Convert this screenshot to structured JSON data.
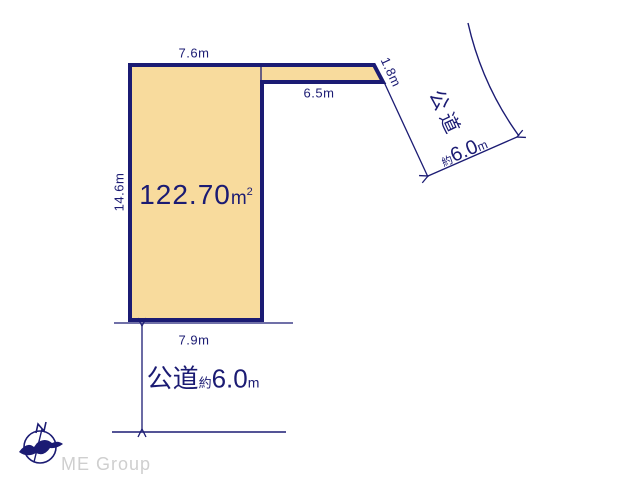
{
  "parcel": {
    "area": {
      "value": "122.70",
      "unit_base": "m",
      "unit_exponent": "2"
    },
    "dimensions": {
      "top": "7.6m",
      "flag_bottom": "6.5m",
      "flag_right": "1.8m",
      "left": "14.6m",
      "bottom": "7.9m"
    }
  },
  "roads": {
    "right": {
      "name": "公道",
      "approx": "約",
      "width": "6.0",
      "unit": "m"
    },
    "bottom": {
      "name": "公道",
      "approx": "約",
      "width": "6.0",
      "unit": "m"
    }
  },
  "branding": {
    "logo_text": "ME Group"
  },
  "colors": {
    "line_navy": "#1B1B73",
    "parcel_fill": "#F8DB9D",
    "logo_gray": "#CFCFCF"
  }
}
